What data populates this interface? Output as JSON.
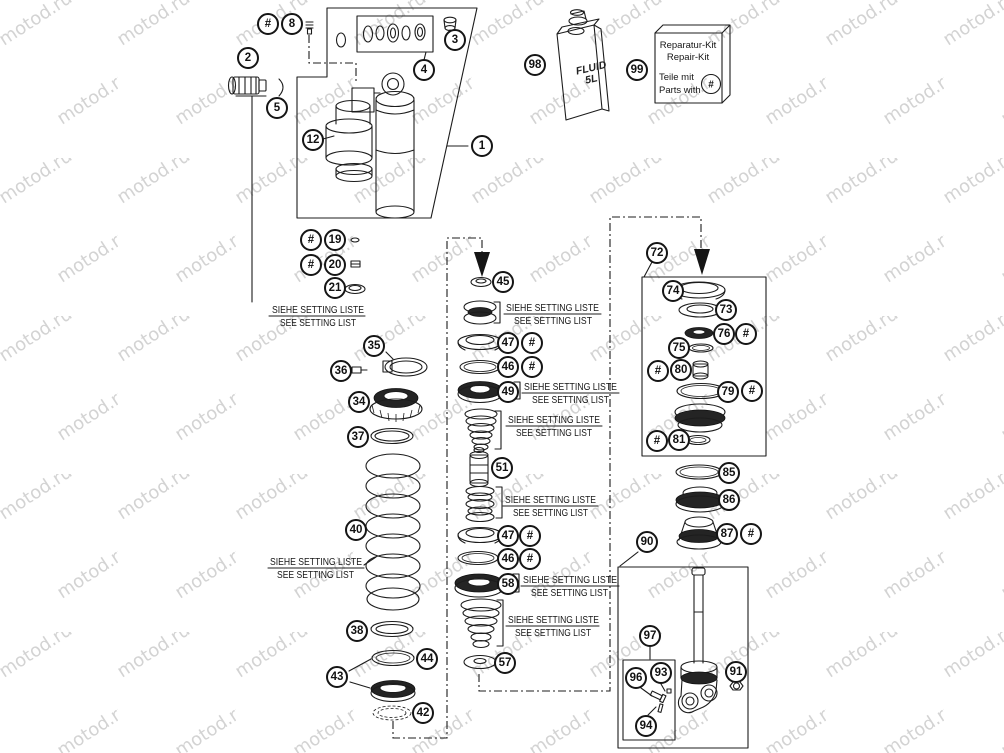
{
  "watermark": {
    "text": "motod.ru",
    "color": "#d3d3d3"
  },
  "labels": {
    "hash": "#",
    "setting_liste": "SIEHE SETTING LISTE",
    "setting_list": "SEE SETTING LIST"
  },
  "fluid": {
    "line1": "FLUID",
    "line2": "5L"
  },
  "repair_kit": {
    "line1": "Reparatur-Kit",
    "line2": "Repair-Kit",
    "line3": "Teile mit",
    "line4": "Parts with",
    "hash": "#"
  },
  "callouts": {
    "1": "1",
    "2": "2",
    "3": "3",
    "4": "4",
    "5": "5",
    "8": "8",
    "12": "12",
    "19": "19",
    "20": "20",
    "21": "21",
    "34": "34",
    "35": "35",
    "36": "36",
    "37": "37",
    "38": "38",
    "40": "40",
    "42": "42",
    "43": "43",
    "44": "44",
    "45": "45",
    "46": "46",
    "47": "47",
    "49": "49",
    "51": "51",
    "57": "57",
    "58": "58",
    "72": "72",
    "73": "73",
    "74": "74",
    "75": "75",
    "76": "76",
    "79": "79",
    "80": "80",
    "81": "81",
    "85": "85",
    "86": "86",
    "87": "87",
    "90": "90",
    "91": "91",
    "93": "93",
    "94": "94",
    "96": "96",
    "97": "97",
    "98": "98",
    "99": "99"
  }
}
